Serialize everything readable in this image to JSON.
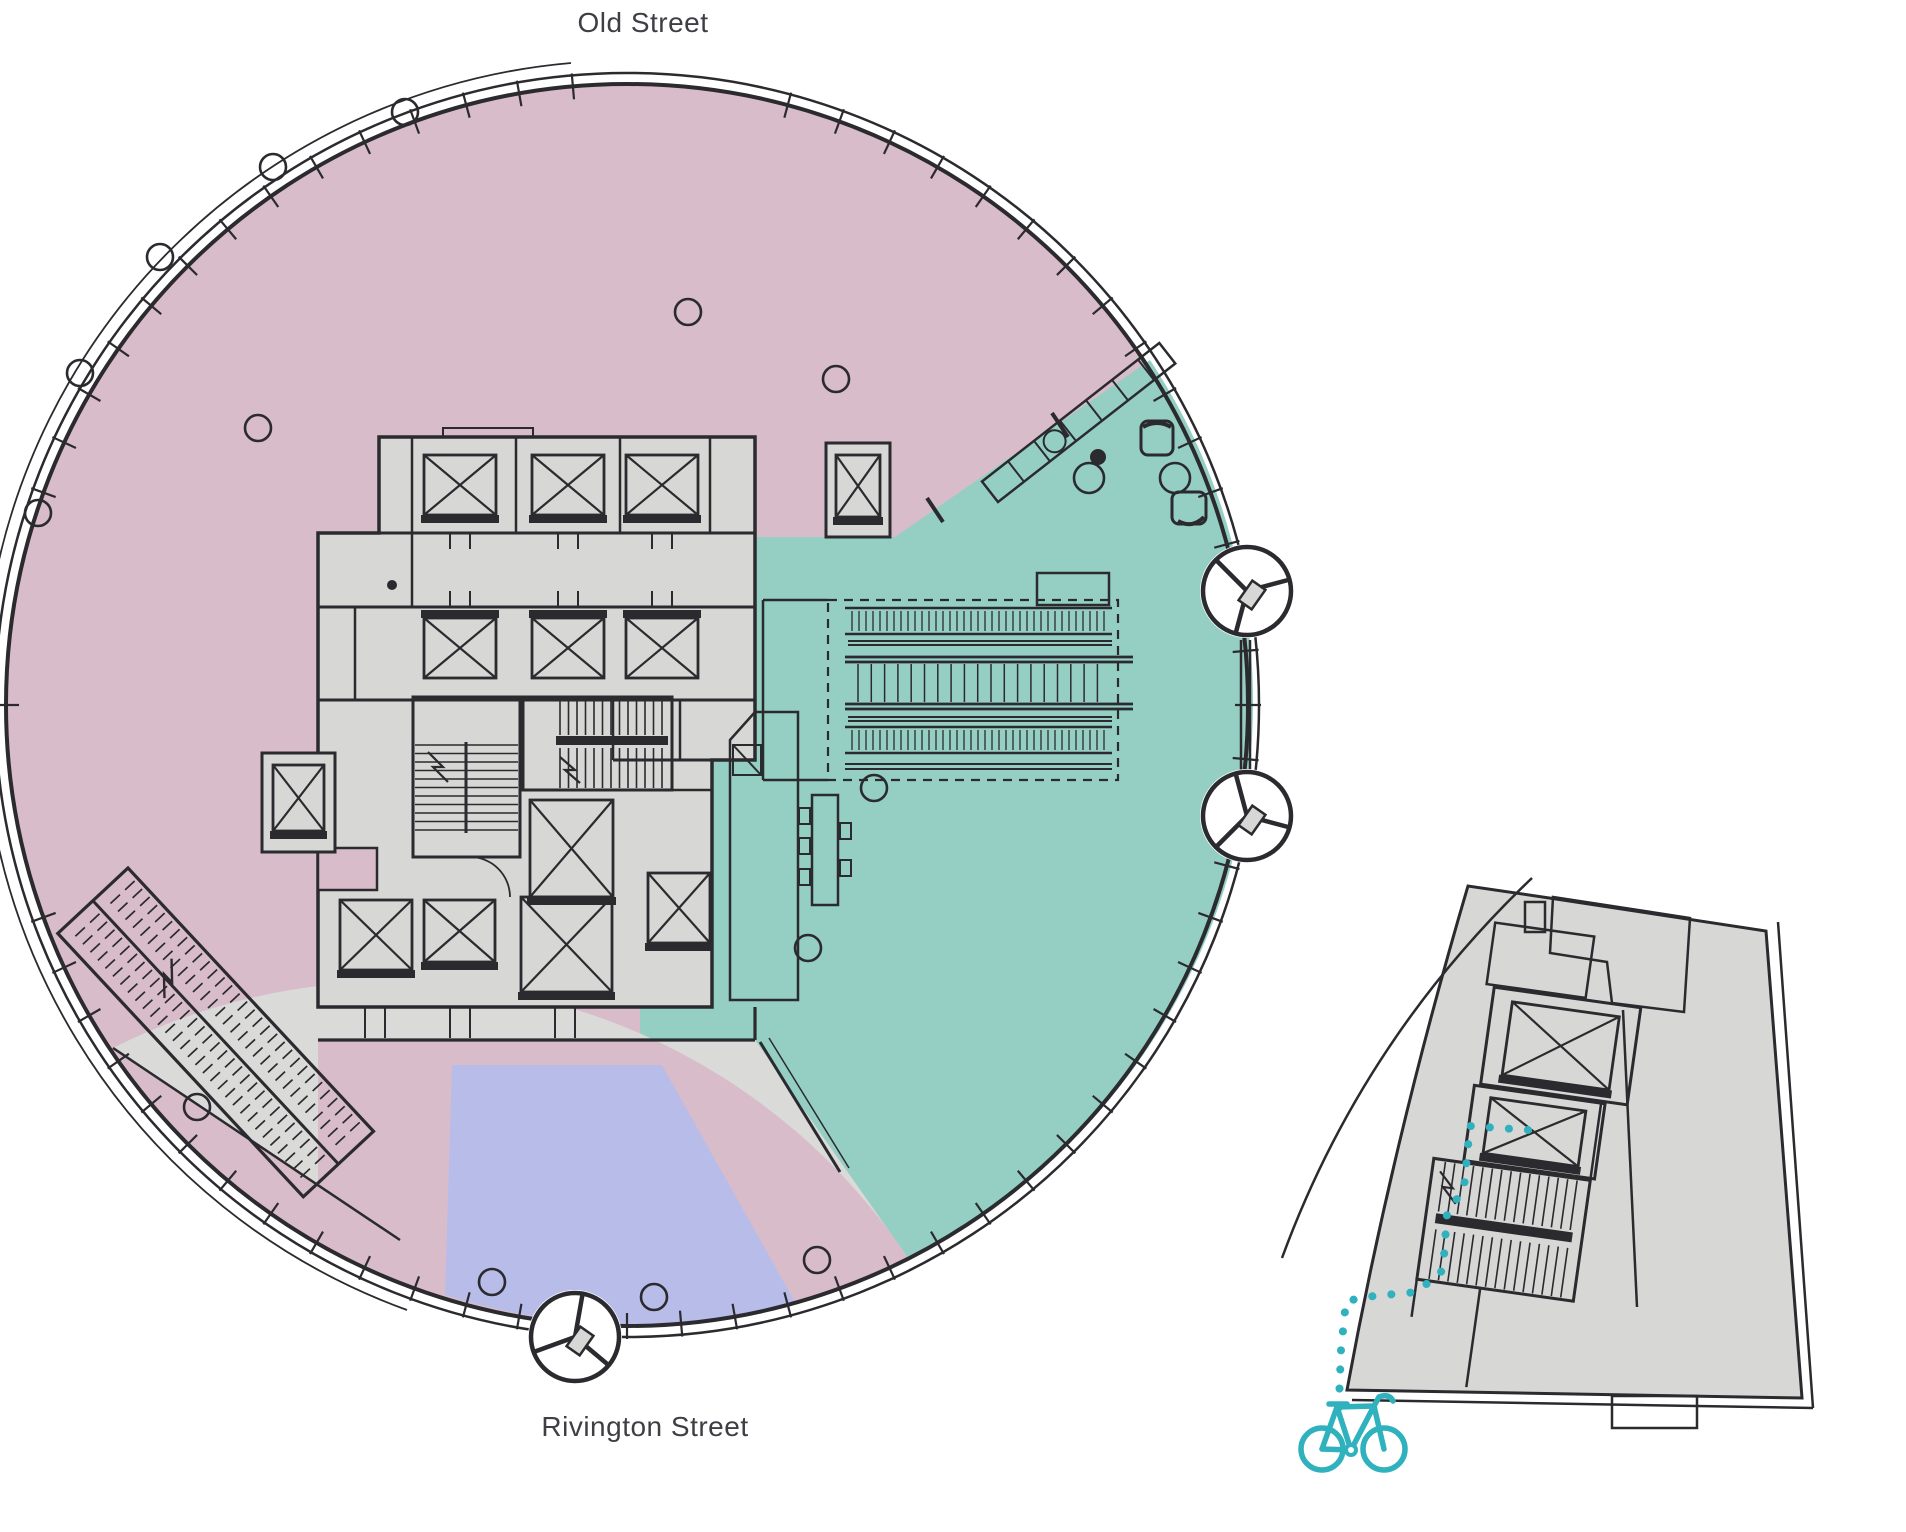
{
  "labels": {
    "top_street": "Old Street",
    "bottom_street": "Rivington Street"
  },
  "colors": {
    "background": "#ffffff",
    "zone_pink": "#d9bcca",
    "zone_teal": "#95cfc3",
    "zone_lavender": "#b8bce8",
    "zone_gray": "#dadad8",
    "core_fill": "#d7d7d5",
    "line": "#2a2a2f",
    "wall": "#17171c",
    "accent_teal": "#2fb2bd",
    "label_text": "#3e3e45"
  },
  "zones": [
    {
      "id": "pink-zone",
      "color_key": "zone_pink"
    },
    {
      "id": "teal-lobby-zone",
      "color_key": "zone_teal"
    },
    {
      "id": "lavender-entrance-zone",
      "color_key": "zone_lavender"
    },
    {
      "id": "gray-service-zone",
      "color_key": "zone_gray"
    }
  ],
  "icons": [
    "revolving-door-icon",
    "bicycle-icon",
    "column-marker",
    "elevator-shaft",
    "stairwell",
    "escalator-bank",
    "reception-desk",
    "armchair-icon",
    "table-icon"
  ],
  "figure": {
    "columns_main": [
      [
        405,
        112
      ],
      [
        273,
        167
      ],
      [
        160,
        257
      ],
      [
        80,
        373
      ],
      [
        38,
        513
      ],
      [
        197,
        1107
      ],
      [
        492,
        1282
      ],
      [
        654,
        1297
      ],
      [
        817,
        1260
      ],
      [
        836,
        379
      ],
      [
        688,
        312
      ],
      [
        258,
        428
      ],
      [
        874,
        788
      ],
      [
        808,
        948
      ]
    ],
    "lounge_tables": [
      [
        1175,
        478
      ],
      [
        1089,
        478
      ]
    ],
    "revolving_doors": [
      [
        1247,
        591
      ],
      [
        1247,
        816
      ],
      [
        575,
        1337
      ]
    ],
    "bike_route": [
      [
        1528,
        1130
      ],
      [
        1470,
        1126
      ],
      [
        1464,
        1188
      ],
      [
        1447,
        1214
      ],
      [
        1443,
        1270
      ],
      [
        1417,
        1292
      ],
      [
        1374,
        1296
      ],
      [
        1346,
        1301
      ],
      [
        1341,
        1350
      ],
      [
        1339,
        1402
      ],
      [
        1338,
        1420
      ]
    ]
  }
}
